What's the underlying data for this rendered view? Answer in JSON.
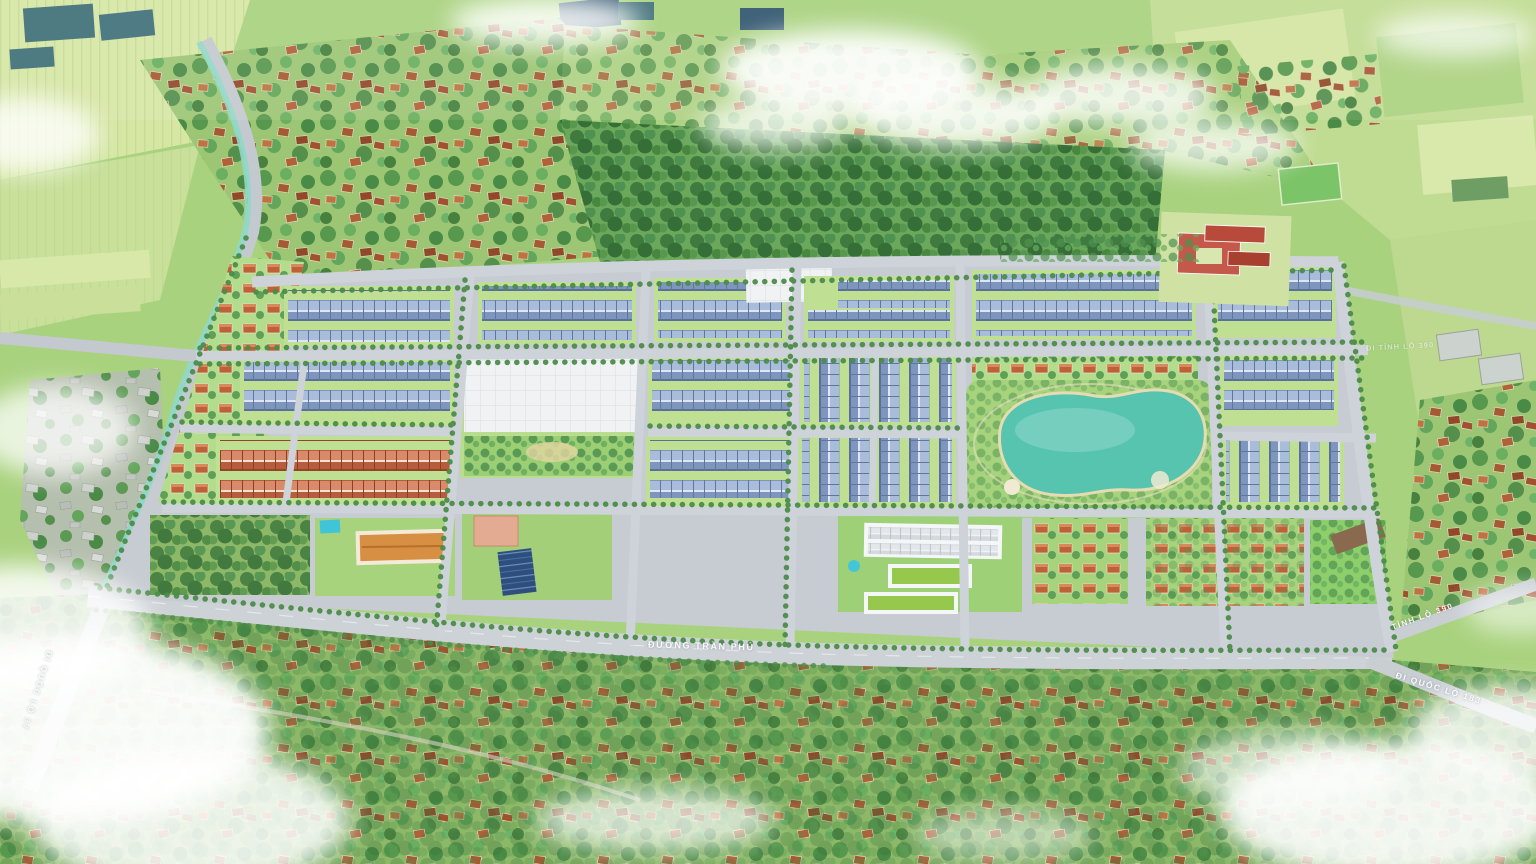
{
  "scene": {
    "type": "aerial-3d-masterplan-render",
    "road_labels": {
      "main_road": "ĐƯỜNG TRẦN PHÚ",
      "to_national_route_183": "ĐI QUỐC LỘ 183",
      "provincial_route_390": "TỈNH LỘ 390",
      "to_national_route_37": "ĐI QUỐC LỘ 37",
      "to_provincial_route_390": "ĐI TỈNH LỘ 390"
    },
    "colors": {
      "base_green": "#a9d27e",
      "field_light": "#d6e7a4",
      "forest_green": "#4e8f4b",
      "village_roof_brown": "#a65a32",
      "row_roof_blue": "#8ba3c9",
      "row_roof_red": "#c26a4a",
      "road_gray": "#c6ccd1",
      "lake_teal": "#57c4b0",
      "plaza_white": "#f0f2f4",
      "school_roof_red": "#c4584a",
      "canal_teal": "#8fd8c8",
      "cloud_white": "#ffffff"
    }
  }
}
